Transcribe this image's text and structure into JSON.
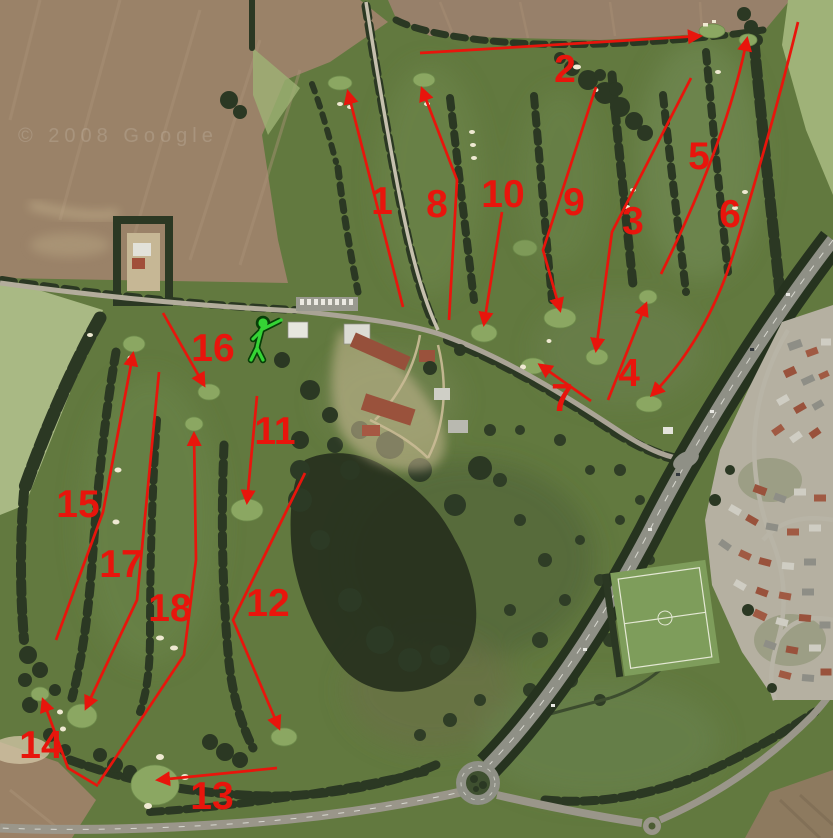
{
  "map": {
    "kind": "aerial-photo",
    "description": "Aerial photo of an 18-hole golf course with red arrows marking each hole routing",
    "watermark": "© 2008 Google",
    "annotation_color": "#e8150c",
    "logo_color": "#35d435",
    "palette": {
      "course_green": "#62793f",
      "ploughed_field_brown": "#9a8268",
      "pale_field_green": "#a9b984",
      "dark_trees": "#2b3823",
      "road_grey": "#8f9086",
      "putting_green": "#8ba762",
      "housing_base": "#b5b0a1",
      "red_roof": "#9a523c"
    },
    "icons": [
      {
        "name": "golfer-icon",
        "meaning": "golf club logo painted on clubhouse lawn"
      }
    ],
    "hole_markers": [
      {
        "number": "1"
      },
      {
        "number": "2"
      },
      {
        "number": "3"
      },
      {
        "number": "4"
      },
      {
        "number": "5"
      },
      {
        "number": "6"
      },
      {
        "number": "7"
      },
      {
        "number": "8"
      },
      {
        "number": "9"
      },
      {
        "number": "10"
      },
      {
        "number": "11"
      },
      {
        "number": "12"
      },
      {
        "number": "13"
      },
      {
        "number": "14"
      },
      {
        "number": "15"
      },
      {
        "number": "16"
      },
      {
        "number": "17"
      },
      {
        "number": "18"
      }
    ]
  }
}
